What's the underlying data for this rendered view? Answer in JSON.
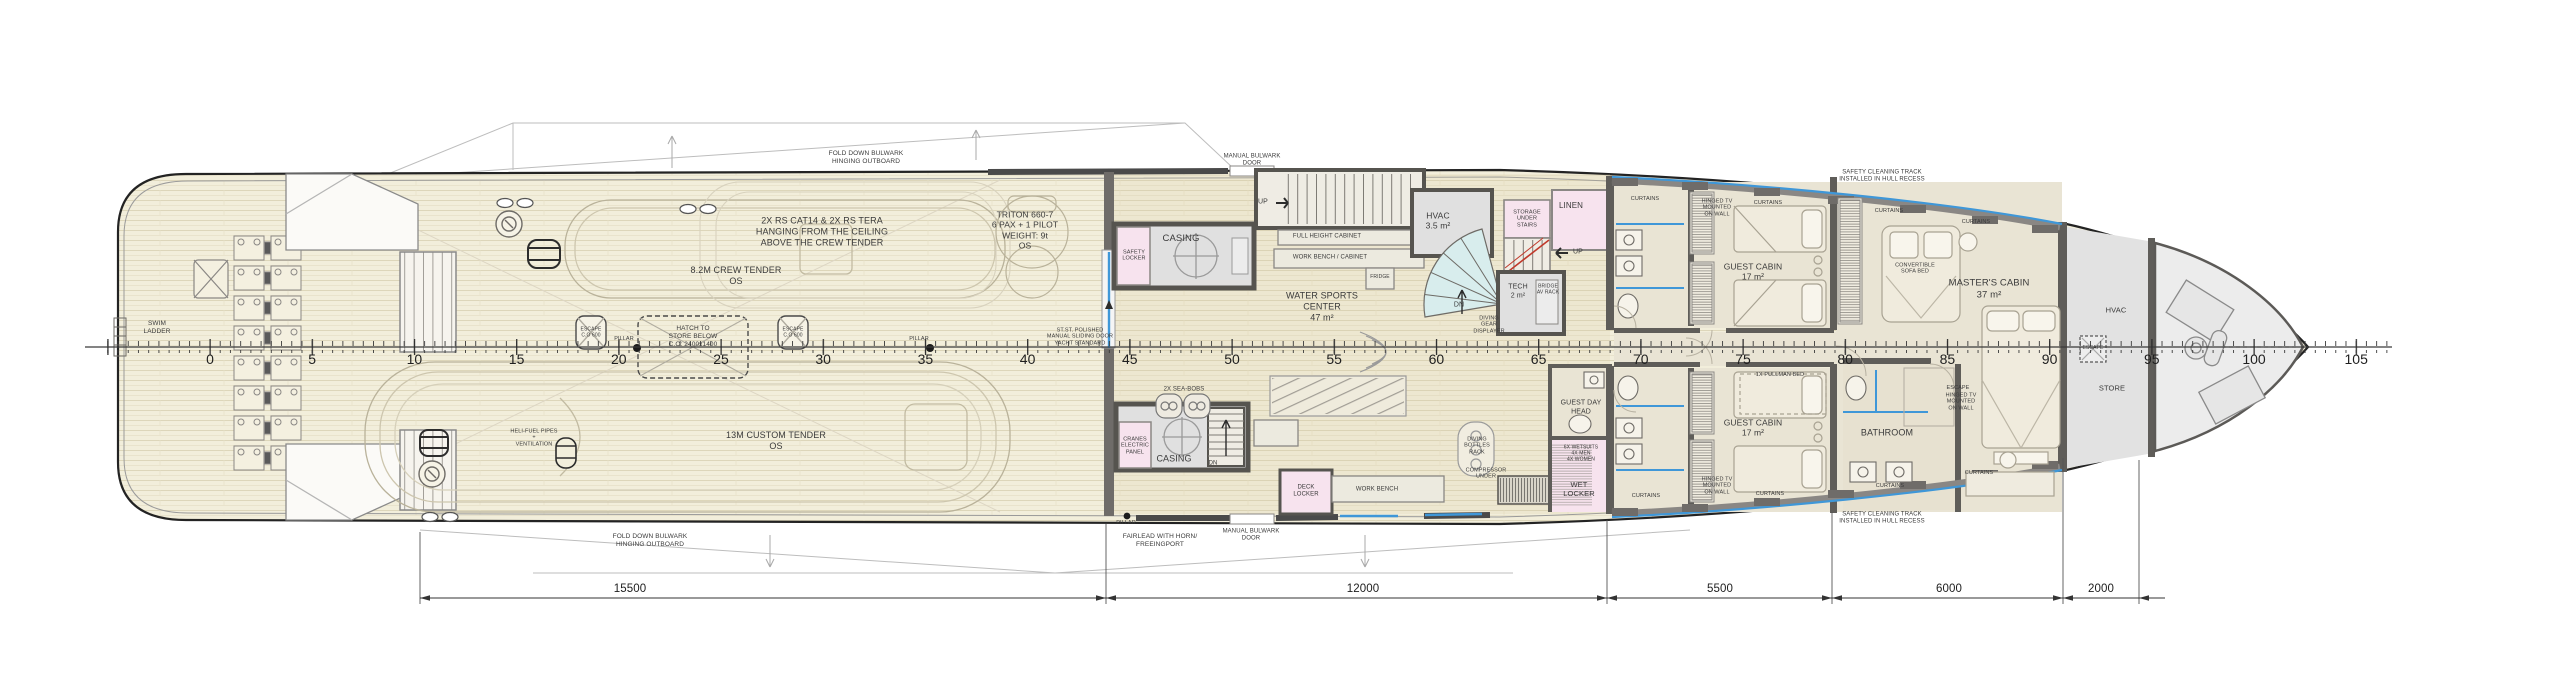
{
  "drawing": {
    "type": "yacht-deck-general-arrangement-plan",
    "colors": {
      "paper": "#ffffff",
      "deck_plank": "#f2eedb",
      "plank_line": "#ddd6ba",
      "cabin_floor": "#e9e4d4",
      "gray_room": "#e0e0e0",
      "pink_room": "#f7e3ee",
      "teal_stair": "#d8eded",
      "wall": "#5f5d59",
      "window_blue": "#3f97d8",
      "escape_red": "#c0392b",
      "hull_line": "#232323"
    }
  },
  "labels": {
    "swim_ladder": "SWIM\nLADDER",
    "fold_down_bulwark": "FOLD DOWN BULWARK\nHINGING OUTBOARD",
    "rs_dinghies": "2X RS CAT14 & 2X RS TERA\nHANGING FROM THE CEILING\nABOVE THE CREW TENDER",
    "crew_tender": "8.2M CREW TENDER\nOS",
    "custom_tender": "13M CUSTOM TENDER\nOS",
    "triton": "TRITON 660-7\n6 PAX + 1 PILOT\nWEIGHT: 9t\nOS",
    "heli_fuel": "HELI-FUEL PIPES\n+\nVENTILATION",
    "escape_hatch": "ESCAPE\nC.O 600",
    "pillar": "PILLAR",
    "hatch_store": "HATCH TO\nSTORE BELOW\nC.O: 2400x1400",
    "manual_bulwark_door": "MANUAL BULWARK\nDOOR",
    "sliding_door": "ST.ST. POLISHED\nMANUAL SLIDING DOOR\nYACHT STANDARD",
    "up": "UP",
    "dn": "DN",
    "safety_locker": "SAFETY\nLOCKER",
    "casing": "CASING",
    "full_height_cabinet": "FULL HEIGHT CABINET",
    "work_bench_cabinet": "WORK BENCH / CABINET",
    "fridge": "FRIDGE",
    "water_sports_center": "WATER SPORTS\nCENTER\n47 m²",
    "hvac_35": "HVAC\n3.5 m²",
    "storage_under_stairs": "STORAGE\nUNDER\nSTAIRS",
    "linen": "LINEN",
    "tech": "TECH\n2 m²",
    "bridge_av_rack": "BRIDGE\nAV RACK",
    "diving_gear_displayer": "DIVING\nGEAR\nDISPLAYER",
    "diving_bottles_rack": "DIVING\nBOTTLES\nRACK",
    "compressor_under": "COMPRESSOR\nUNDER",
    "work_bench": "WORK BENCH",
    "deck_locker": "DECK\nLOCKER",
    "sea_bobs": "2X SEA-BOBS",
    "cranes_electric_panel": "CRANES\nELECTRIC\nPANEL",
    "fairlead": "FAIRLEAD WITH HORN/\nFREEINGPORT",
    "guest_day_head": "GUEST DAY\nHEAD",
    "wet_locker": "WET\nLOCKER",
    "wetsuits": "6X WETSUITS\n4X MEN\n4X WOMEN",
    "guest_cabin": "GUEST CABIN\n17 m²",
    "pullman_bed": "1X PULLMAN BED",
    "hinged_tv": "HINGED TV\nMOUNTED\nON WALL",
    "curtains": "CURTAINS",
    "bathroom": "BATHROOM",
    "escape": "ESCAPE",
    "safety_cleaning_track": "SAFETY CLEANING TRACK\nINSTALLED IN HULL RECESS",
    "convertible_sofa_bed": "CONVERTIBLE\nSOFA BED",
    "masters_cabin": "MASTER'S CABIN\n37 m²",
    "hvac": "HVAC",
    "store": "STORE"
  },
  "axis": {
    "stations": [
      "0",
      "5",
      "10",
      "15",
      "20",
      "25",
      "30",
      "35",
      "40",
      "45",
      "50",
      "55",
      "60",
      "65",
      "70",
      "75",
      "80",
      "85",
      "90",
      "95",
      "100",
      "105"
    ]
  },
  "dimensions": [
    "15500",
    "12000",
    "5500",
    "6000",
    "2000"
  ]
}
